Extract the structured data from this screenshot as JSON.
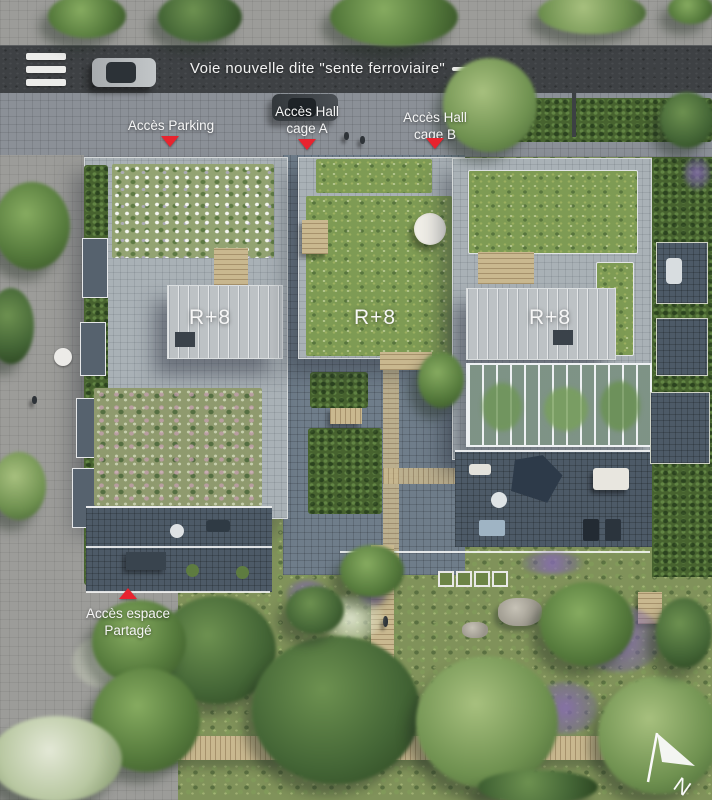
{
  "title": "Aerial site plan — residential masterplan",
  "road": {
    "name_label": "Voie nouvelle dite \"sente ferroviaire\""
  },
  "markers": {
    "parking": {
      "label": "Accès Parking"
    },
    "hall_a": {
      "line1": "Accès Hall",
      "line2": "cage A"
    },
    "hall_b": {
      "line1": "Accès Hall",
      "line2": "cage B"
    },
    "espace": {
      "line1": "Accès espace",
      "line2": "Partagé"
    }
  },
  "buildings": {
    "left": {
      "floors_label": "R+8"
    },
    "middle": {
      "floors_label": "R+8"
    },
    "right": {
      "floors_label": "R+8"
    }
  },
  "compass": {
    "north_label": "N"
  },
  "icons": {
    "crosswalk": "crosswalk-stripes",
    "direction_arrow": "arrow-right",
    "north_arrow": "compass-north-arrow"
  },
  "colors": {
    "marker_red": "#e8232e",
    "label_white": "#f5f5f5",
    "road_asphalt": "#3e4144",
    "green_roof": "#7e9b54",
    "courtyard_paving": "#6f7d8a"
  }
}
